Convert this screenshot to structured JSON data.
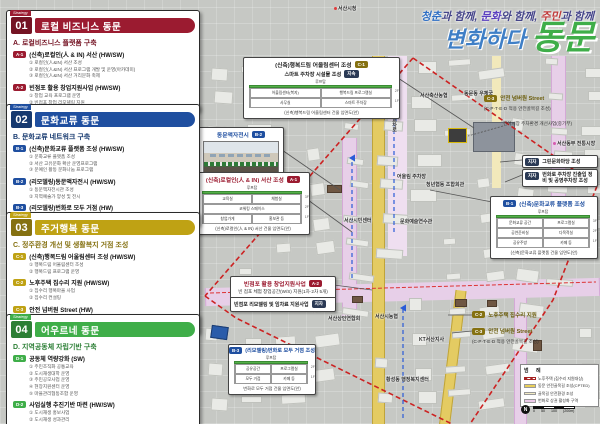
{
  "header": {
    "tagline_parts": [
      {
        "text": "청춘",
        "color": "#2f6fc4"
      },
      {
        "text": "과 함께, ",
        "color": "#45458a"
      },
      {
        "text": "문화",
        "color": "#5a3fbf"
      },
      {
        "text": "와 함께, ",
        "color": "#45458a"
      },
      {
        "text": "주민",
        "color": "#c03a3a"
      },
      {
        "text": "과 함께",
        "color": "#45458a"
      }
    ],
    "title_script": "변화하다",
    "title_main": "동문"
  },
  "sections": [
    {
      "tag": "Strategy",
      "num": "01",
      "title": "로컬 비즈니스 동문",
      "subtitle": "A. 로컬비즈니스 플랫폼 구축",
      "accent": "#9b1b30",
      "dark": "#741323",
      "items": [
        {
          "code": "A-1",
          "title": "(신축)로컬인(人 & IN) 서산 (HW/SW)",
          "bullets": [
            "① 로컬인(人&IN) 서산 조성",
            "② 로컬인(人&IN) 서산 프로그램 개발 및 운영(아카데미)",
            "③ 로컬인(人&IN) 서산 거리문화 축제"
          ]
        },
        {
          "code": "A-2",
          "title": "빈점포 활용 창업지원사업 (HW/SW)",
          "bullets": [
            "① 창업 교육 프로그램 운영",
            "② 빈점포 창업 리모델링 지원"
          ]
        }
      ]
    },
    {
      "tag": "Strategy",
      "num": "02",
      "title": "문화교류 동문",
      "subtitle": "B. 문화교류 네트워크 구축",
      "accent": "#1f4fa0",
      "dark": "#16396f",
      "items": [
        {
          "code": "B-1",
          "title": "(신축)문화교류 플랫폼 조성 (HW/SW)",
          "bullets": [
            "① 문화교류 플랫폼 조성",
            "② 서산 고유문화 확산 운영프로그램",
            "③ 문예인 활동 문화나눔 프로그램"
          ]
        },
        {
          "code": "B-2",
          "title": "(리모델링)동문액자전시 (HW/SW)",
          "bullets": [
            "① 동문액자전시관 조성",
            "② 지역예술가 양성 및 전시"
          ]
        },
        {
          "code": "B-3",
          "title": "(리모델링)번화로 모두 거점 (HW)",
          "bullets": [
            "① 번화로 모두 거점 조성"
          ]
        }
      ]
    },
    {
      "tag": "Strategy",
      "num": "03",
      "title": "주거행복 동문",
      "subtitle": "C. 정주환경 개선 및 생활복지 거점 조성",
      "accent": "#bfa214",
      "dark": "#857111",
      "items": [
        {
          "code": "C-1",
          "title": "(신축)행복드림 어울림센터 조성 (HW/SW)",
          "bullets": [
            "① 행복드림 어울림센터 조성",
            "② 행복드림 프로그램 운영"
          ]
        },
        {
          "code": "C-2",
          "title": "노후주택 집수리 지원 (HW/SW)",
          "bullets": [
            "① 집수리 행복마을 사업",
            "② 집수리 컨설팅"
          ]
        },
        {
          "code": "C-3",
          "title": "안전 넘버원 Street (HW)",
          "bullets": [
            "① 골목길 안전환경 조성",
            "② 동문 안전골목길 조성(CPTED)"
          ]
        }
      ]
    },
    {
      "tag": "Strategy",
      "num": "04",
      "title": "어우르네 동문",
      "subtitle": "D. 지역공동체 자립기반 구축",
      "accent": "#3fae49",
      "dark": "#2c7f35",
      "items": [
        {
          "code": "D-1",
          "title": "공동체 역량강화 (SW)",
          "bullets": [
            "① 주민조직화 공통교육",
            "② 도시재생대학 운영",
            "③ 주민공모사업 운영",
            "④ 현장지원센터 운영",
            "⑤ 마을관리협동조합 운영"
          ]
        },
        {
          "code": "D-2",
          "title": "사업실행 추진기반 마련 (HW/SW)",
          "bullets": [
            "① 도시재생 홍보사업",
            "② 도시재생 성과관리"
          ]
        }
      ]
    }
  ],
  "map": {
    "callouts": {
      "c1": {
        "badge": "C-1",
        "title": "(신축)행복드림 어울림센터 조성",
        "sub": "스마트 주차장 시설물 조성",
        "sub_badge": "지속",
        "caption": "(신축)행복드림 어울림센터 건물 입면도(안)"
      },
      "b2": {
        "badge": "B-2",
        "title": "동문액자전시"
      },
      "a1": {
        "badge": "A-1",
        "title": "(신축)로컬인(人 & IN) 서산 조성",
        "caption": "(신축)로컬인(人 & IN) 서산 건물 입면도(안)"
      },
      "b1": {
        "badge": "B-1",
        "title": "(신축)문화교류 플랫폼 조성",
        "caption": "(신축)문화교류 플랫폼 건물 입면도(안)"
      },
      "a2": {
        "badge": "A-2",
        "title": "빈점포 활용 창업지원사업",
        "sub": "빈 점포 체험 창업공간(W/S) 지원(1차·2차 5개)",
        "attach": "빈점포 리모델링 및 임차료 지원사업",
        "attach_badge": "지자"
      },
      "b3": {
        "badge": "B-3",
        "title": "(리모델링)번화로 모두 거점 조성",
        "caption": "번화로 모두 거점 건물 입면도(안)"
      },
      "c3_top": {
        "badge": "C-3",
        "title": "안전 넘버원 Street",
        "sub": "(C·P·T·E·D 적용 안전골목길 조성)"
      },
      "fish_market": {
        "title": "건어시장 주차환경 개선사업(중기부)"
      },
      "green_plaza": {
        "badge": "지자",
        "title": "그린문화마당 조성"
      },
      "parking": {
        "badge": "지자",
        "title": "번화로 주차장 진출입 정비 및 공영주차장 조성"
      },
      "c2_bot": {
        "badge": "C-2",
        "title": "노후주택 집수리 지원"
      },
      "c3_bot": {
        "badge": "C-3",
        "title": "안전 넘버원 Street",
        "sub": "(C·P·T·E·D 적용 안전골목길 조성)"
      }
    },
    "tables": {
      "c1": {
        "header": "루프탑",
        "floors": [
          {
            "floor": "2F",
            "cells": [
              "어울림센터(복지)",
              "행복드림 프로그램실"
            ]
          },
          {
            "floor": "1F",
            "cells": [
              "사무실",
              "스마트 주차장"
            ]
          }
        ]
      },
      "a1": {
        "header": "루프탑",
        "floors": [
          {
            "floor": "3F",
            "cells": [
              "교육실",
              "체험실"
            ]
          },
          {
            "floor": "2F",
            "cells": [
              "코워킹 스페이스"
            ]
          },
          {
            "floor": "1F",
            "cells": [
              "창업가게",
              "홍보관 등"
            ]
          }
        ]
      },
      "b1": {
        "header": "루프탑",
        "floors": [
          {
            "floor": "3F",
            "cells": [
              "문화교류 공간",
              "프로그램실"
            ]
          },
          {
            "floor": "2F",
            "cells": [
              "공연준비실",
              "다목적실"
            ]
          },
          {
            "floor": "1F",
            "cells": [
              "공유주방",
              "카페 등"
            ]
          }
        ]
      },
      "b3": {
        "header": "루프탑",
        "floors": [
          {
            "floor": "2F",
            "cells": [
              "공유공간",
              "프로그램실"
            ]
          },
          {
            "floor": "1F",
            "cells": [
              "모두 거점",
              "카페 등"
            ]
          }
        ]
      }
    },
    "labels": [
      {
        "t": "서산시청",
        "x": 334,
        "y": 5,
        "dot": "#e03c3c"
      },
      {
        "t": "서산축산농협",
        "x": 420,
        "y": 92
      },
      {
        "t": "동문동 우체국",
        "x": 464,
        "y": 90
      },
      {
        "t": "서산동부 전통시장",
        "x": 553,
        "y": 140,
        "dot": "#d65bb0"
      },
      {
        "t": "1호광장 교차로",
        "x": 391,
        "y": 98,
        "vert": true
      },
      {
        "t": "어울림 주차장",
        "x": 397,
        "y": 173
      },
      {
        "t": "청년협동 조합회관",
        "x": 426,
        "y": 181
      },
      {
        "t": "서산시민센터",
        "x": 344,
        "y": 217
      },
      {
        "t": "문화예술연수관",
        "x": 400,
        "y": 218
      },
      {
        "t": "서산상인연합회",
        "x": 328,
        "y": 315
      },
      {
        "t": "서산시농협",
        "x": 375,
        "y": 313
      },
      {
        "t": "황성동 행정복지센터",
        "x": 386,
        "y": 376
      },
      {
        "t": "KT서산지사",
        "x": 419,
        "y": 336
      }
    ],
    "legend": {
      "title": "범 례",
      "rows": [
        {
          "label": "노후주택 (집수리 지원대상)",
          "swatch": "hatch"
        },
        {
          "label": "동문 안전골목길 조성(CPTED)",
          "swatch": "#e8cf5a"
        },
        {
          "label": "골목길 안전환경 조성",
          "swatch": "#f3ecc4"
        },
        {
          "label": "번화로 상권 활성화 구역",
          "swatch": "#ecc9e8"
        }
      ],
      "scale_ticks": [
        "0",
        "50",
        "100",
        "(200m)"
      ],
      "north": "N"
    }
  }
}
